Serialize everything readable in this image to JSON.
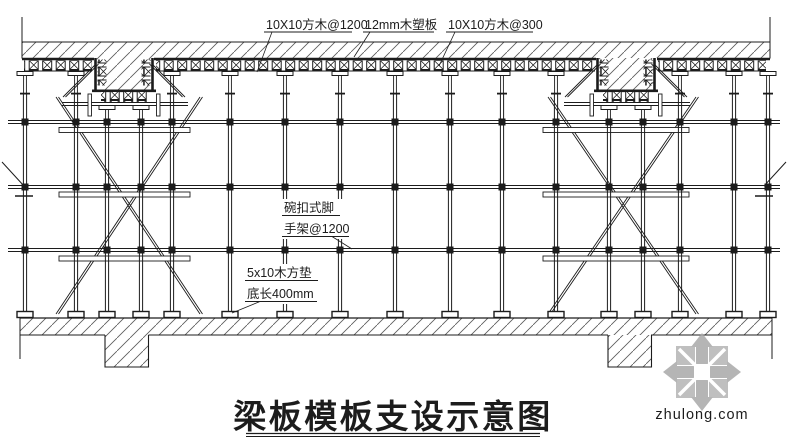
{
  "figure": {
    "title": "梁板模板支设示意图",
    "labels": {
      "joist_1200": "10X10方木@1200",
      "plank_12mm": "12mm木塑板",
      "joist_300": "10X10方木@300",
      "scaffold_line1": "碗扣式脚",
      "scaffold_line2": "手架@1200",
      "pad_line1": "5x10木方垫",
      "pad_line2": "底长400mm"
    }
  },
  "watermark": {
    "text": "zhulong.com"
  },
  "colors": {
    "line": "#1c1c1c",
    "hatch": "#5a5a5a",
    "watermark_gray": "#b8b8b8",
    "background": "#ffffff"
  }
}
